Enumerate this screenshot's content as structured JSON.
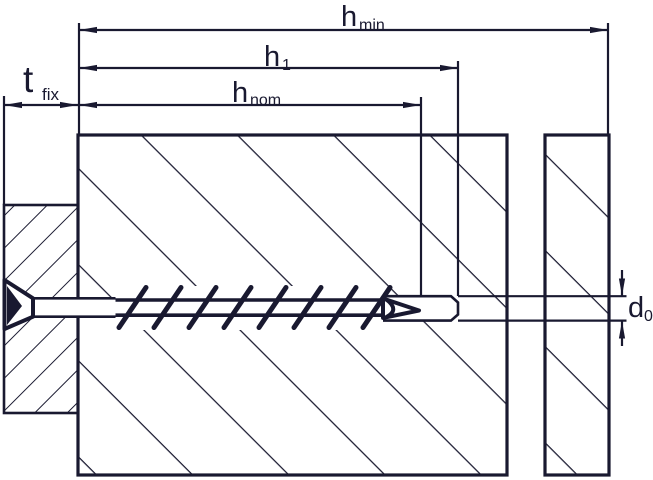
{
  "diagram": {
    "ink_color": "#191930",
    "background_color": "#ffffff",
    "labels": {
      "hmin": {
        "base": "h",
        "sub": "min"
      },
      "h1": {
        "base": "h",
        "sub": "1"
      },
      "hnom": {
        "base": "h",
        "sub": "nom"
      },
      "tfix": {
        "base": "t",
        "sub": "fix"
      },
      "d0": {
        "base": "d",
        "sub": "0"
      }
    }
  }
}
